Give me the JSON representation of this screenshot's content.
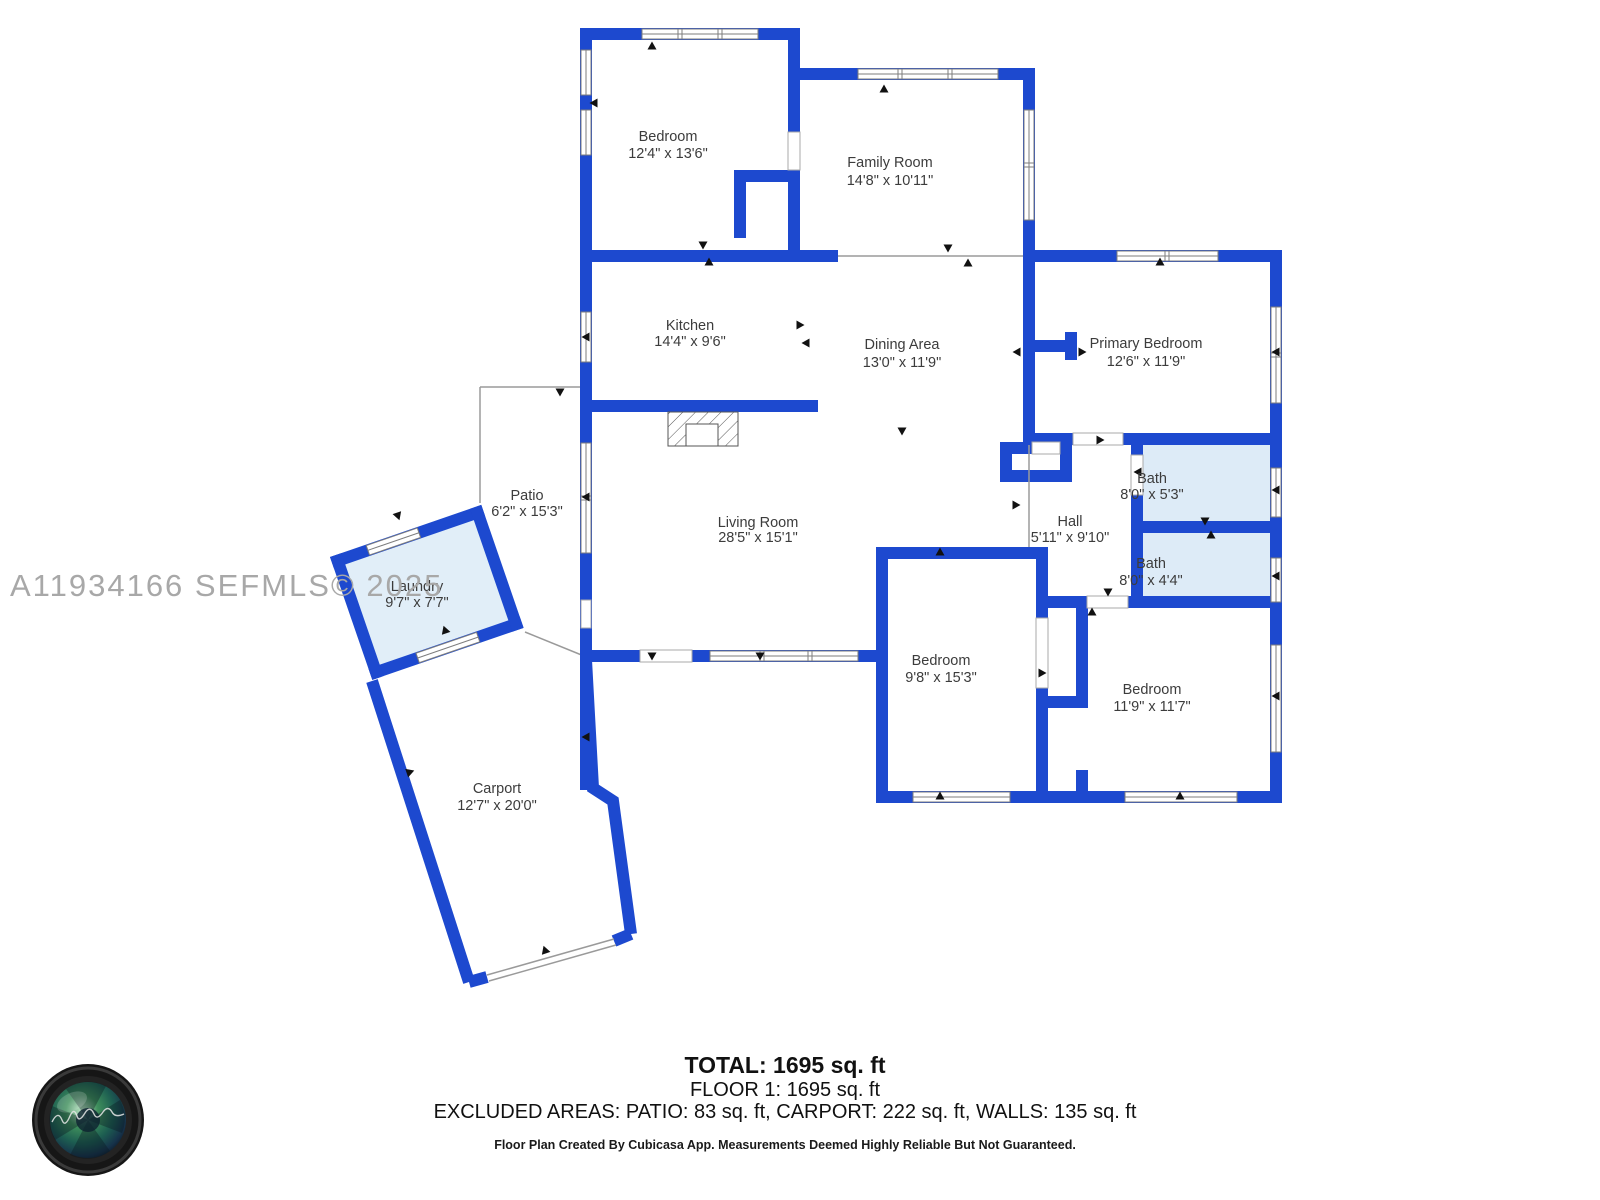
{
  "watermark": "A11934166  SEFMLS© 2025",
  "rooms": [
    {
      "name": "Bedroom",
      "dims": "12'4\" x 13'6\""
    },
    {
      "name": "Family Room",
      "dims": "14'8\" x 10'11\""
    },
    {
      "name": "Kitchen",
      "dims": "14'4\" x 9'6\""
    },
    {
      "name": "Dining Area",
      "dims": "13'0\" x 11'9\""
    },
    {
      "name": "Primary Bedroom",
      "dims": "12'6\" x 11'9\""
    },
    {
      "name": "Bath",
      "dims": "8'0\" x 5'3\""
    },
    {
      "name": "Hall",
      "dims": "5'11\" x 9'10\""
    },
    {
      "name": "Bath",
      "dims": "8'0\" x 4'4\""
    },
    {
      "name": "Living Room",
      "dims": "28'5\" x 15'1\""
    },
    {
      "name": "Patio",
      "dims": "6'2\" x 15'3\""
    },
    {
      "name": "Laundry",
      "dims": "9'7\" x 7'7\""
    },
    {
      "name": "Bedroom",
      "dims": "9'8\" x 15'3\""
    },
    {
      "name": "Bedroom",
      "dims": "11'9\" x 11'7\""
    },
    {
      "name": "Carport",
      "dims": "12'7\" x 20'0\""
    }
  ],
  "footer": {
    "total": "TOTAL: 1695 sq. ft",
    "floor": "FLOOR 1: 1695 sq. ft",
    "excluded": "EXCLUDED AREAS: PATIO: 83 sq. ft, CARPORT: 222 sq. ft, WALLS: 135 sq. ft",
    "disclaimer": "Floor Plan Created By Cubicasa App. Measurements Deemed Highly Reliable But Not Guaranteed."
  },
  "colors": {
    "wall": "#1d49cf",
    "wet_room_fill": "#ddebf7",
    "laundry_fill": "#e1eef8",
    "watermark": "#a8a8a8",
    "label": "#3c3c3c"
  }
}
